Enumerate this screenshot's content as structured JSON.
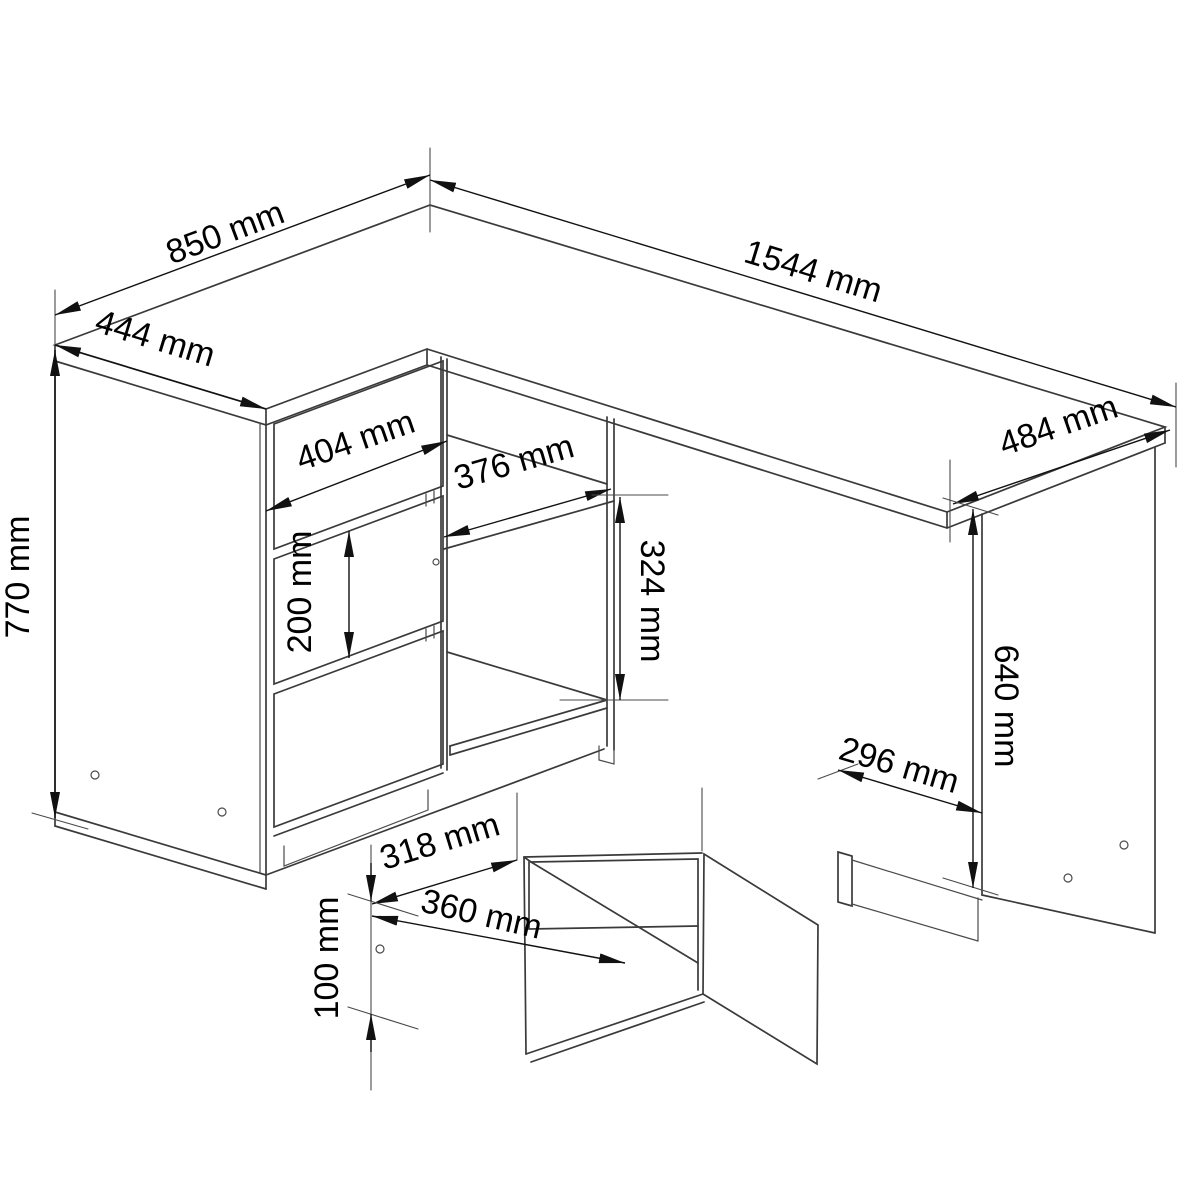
{
  "diagram": {
    "kind": "furniture technical drawing",
    "subject": "corner desk with drawer cabinet, open niche, side cabinet and detail of a drawer box",
    "unit": "mm",
    "line_color": "#3a3a3a",
    "background_color": "#ffffff"
  },
  "dims": {
    "return_depth": {
      "label": "850 mm",
      "value": 850
    },
    "return_width": {
      "label": "444 mm",
      "value": 444
    },
    "top_width": {
      "label": "1544 mm",
      "value": 1544
    },
    "top_depth": {
      "label": "484 mm",
      "value": 484
    },
    "desk_height": {
      "label": "770 mm",
      "value": 770
    },
    "drawer_width": {
      "label": "404 mm",
      "value": 404
    },
    "drawer_mid_height": {
      "label": "200 mm",
      "value": 200
    },
    "niche_width": {
      "label": "376 mm",
      "value": 376
    },
    "niche_height": {
      "label": "324 mm",
      "value": 324
    },
    "side_cab_depth": {
      "label": "296 mm",
      "value": 296
    },
    "side_cab_height": {
      "label": "640 mm",
      "value": 640
    },
    "box_inner_width": {
      "label": "318 mm",
      "value": 318
    },
    "box_outer_width": {
      "label": "360 mm",
      "value": 360
    },
    "box_height": {
      "label": "100 mm",
      "value": 100
    }
  }
}
